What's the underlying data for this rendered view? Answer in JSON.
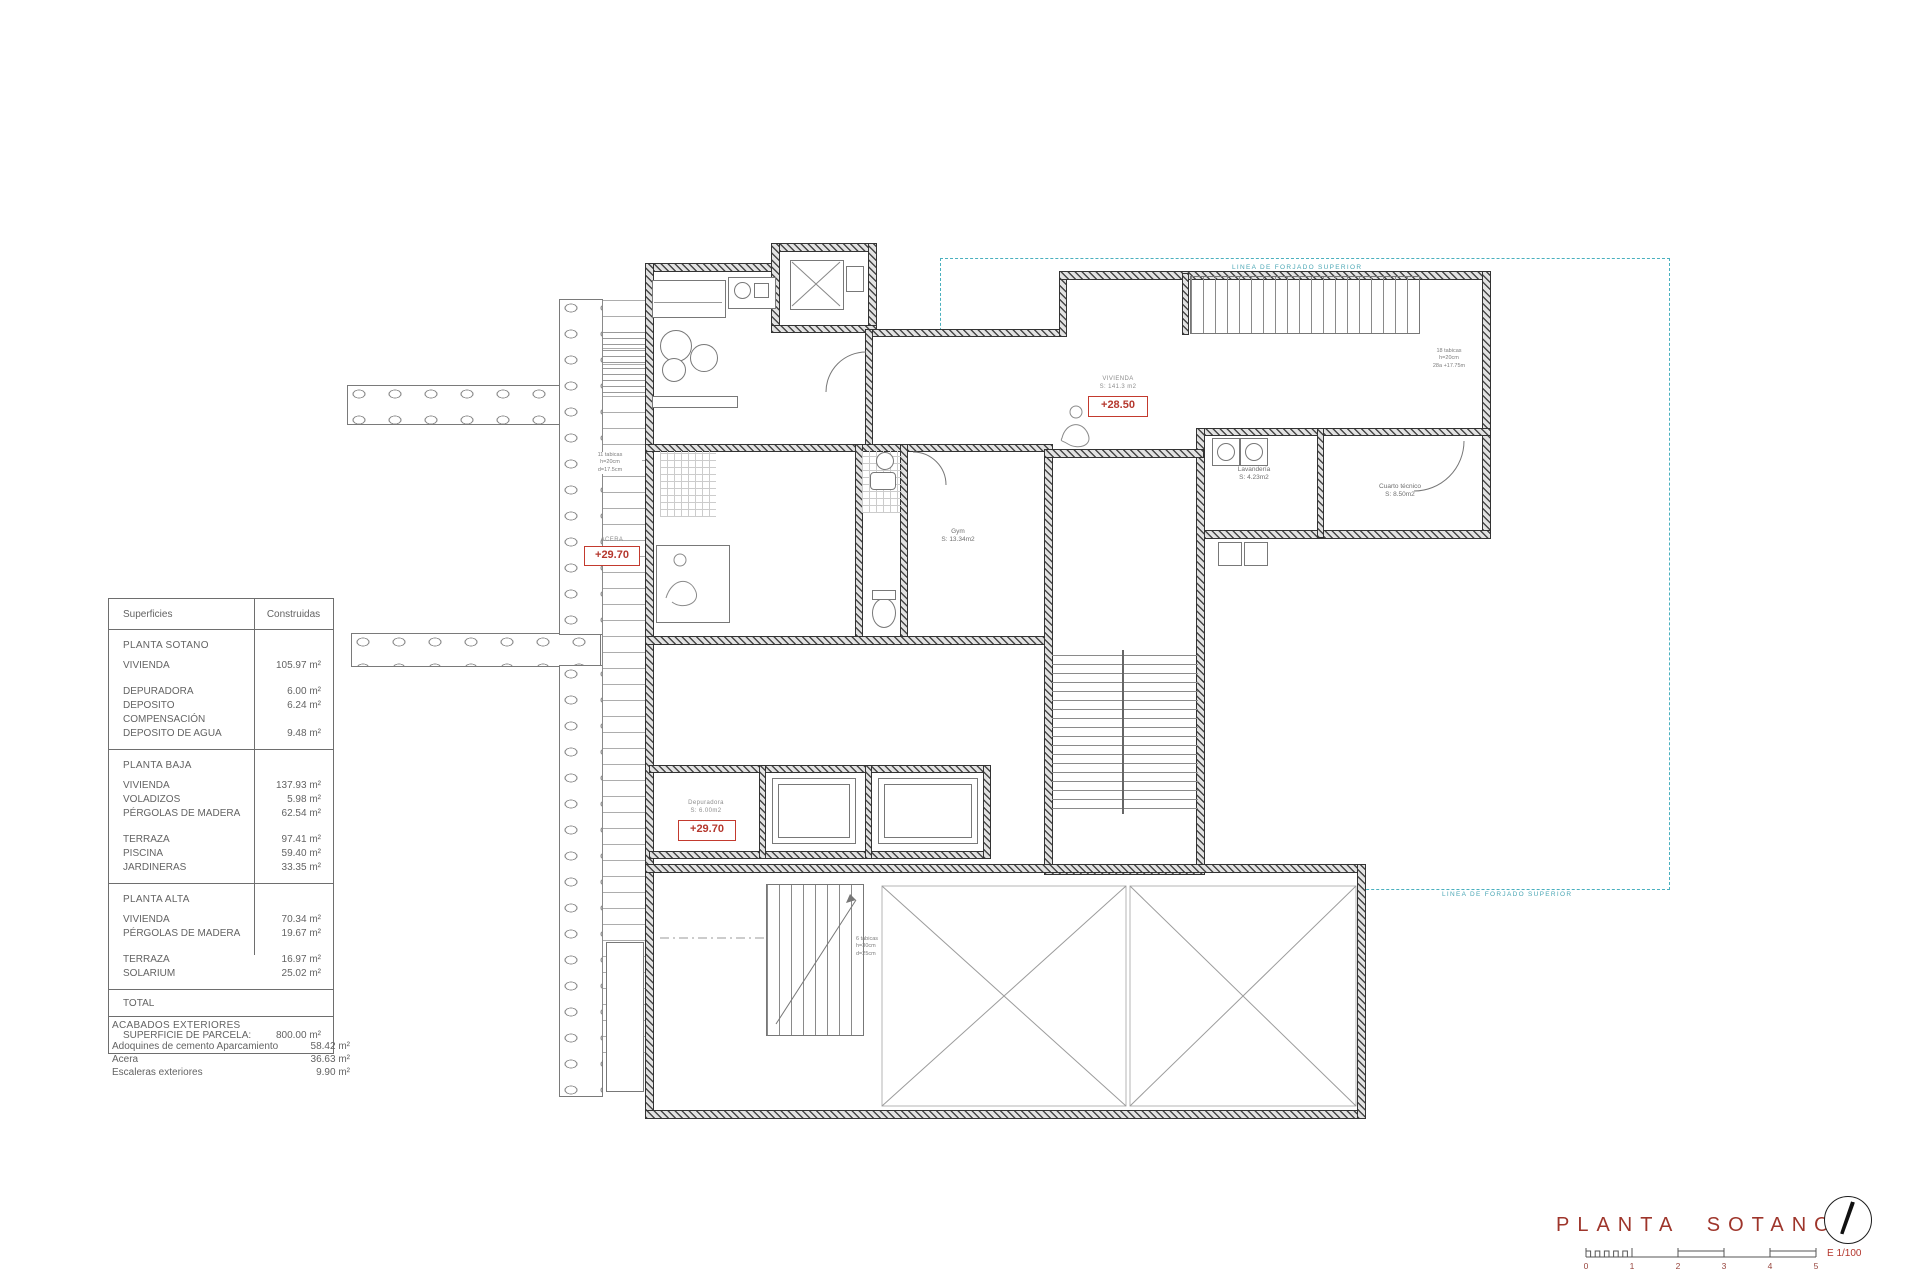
{
  "surfaces_table": {
    "header": {
      "superficies": "Superficies",
      "construidas": "Construidas"
    },
    "planta_sotano": {
      "title": "PLANTA SOTANO",
      "rows": [
        {
          "label": "VIVIENDA",
          "value": "105.97 m²"
        },
        {
          "label": "DEPURADORA",
          "value": "6.00 m²"
        },
        {
          "label": "DEPOSITO COMPENSACIÓN",
          "value": "6.24 m²"
        },
        {
          "label": "DEPOSITO DE AGUA",
          "value": "9.48 m²"
        }
      ]
    },
    "planta_baja": {
      "title": "PLANTA BAJA",
      "rows": [
        {
          "label": "VIVIENDA",
          "value": "137.93 m²"
        },
        {
          "label": "VOLADIZOS",
          "value": "5.98 m²"
        },
        {
          "label": "PÉRGOLAS DE MADERA",
          "value": "62.54 m²"
        },
        {
          "label": "TERRAZA",
          "value": "97.41 m²"
        },
        {
          "label": "PISCINA",
          "value": "59.40 m²"
        },
        {
          "label": "JARDINERAS",
          "value": "33.35 m²"
        }
      ]
    },
    "planta_alta": {
      "title": "PLANTA ALTA",
      "rows": [
        {
          "label": "VIVIENDA",
          "value": "70.34 m²"
        },
        {
          "label": "PÉRGOLAS DE MADERA",
          "value": "19.67 m²"
        },
        {
          "label": "TERRAZA",
          "value": "16.97 m²"
        },
        {
          "label": "SOLARIUM",
          "value": "25.02 m²"
        }
      ]
    },
    "total_label": "TOTAL",
    "parcela_label": "SUPERFICIE DE PARCELA:",
    "parcela_value": "800.00 m²"
  },
  "acabados": {
    "title": "ACABADOS EXTERIORES",
    "rows": [
      {
        "label": "Adoquines de cemento Aparcamiento",
        "value": "58.42 m²"
      },
      {
        "label": "Acera",
        "value": "36.63 m²"
      },
      {
        "label": "Escaleras exteriores",
        "value": "9.90 m²"
      }
    ]
  },
  "plan": {
    "forjado_top": "LINEA DE FORJADO SUPERIOR",
    "forjado_bottom": "LINEA DE FORJADO SUPERIOR",
    "levels": {
      "acera": {
        "caption": "ACERA",
        "value": "+29.70"
      },
      "depuradora": {
        "caption1": "Depuradora",
        "caption2": "S: 6.00m2",
        "value": "+29.70"
      },
      "vivienda": {
        "caption1": "VIVIENDA",
        "caption2": "S: 141.3 m2",
        "value": "+28.50"
      }
    },
    "rooms": {
      "gym": {
        "name": "Gym",
        "area": "S: 13.34m2"
      },
      "lavanderia": {
        "name": "Lavandería",
        "area": "S: 4.23m2"
      },
      "cuarto_tecnico": {
        "name": "Cuarto técnico",
        "area": "S: 8.50m2"
      }
    },
    "stair_notes": {
      "interior": {
        "l1": "18 tabicas",
        "l2": "h=20cm",
        "l3": "28a +17.75m"
      },
      "exterior": {
        "l1": "11 tabicas",
        "l2": "h=20cm",
        "l3": "d=17.5cm"
      },
      "garage": {
        "l1": "6 tabicas",
        "l2": "h=30cm",
        "l3": "d=25cm"
      }
    }
  },
  "titleblock": {
    "title": "PLANTA SOTANO",
    "scale": "E 1/100",
    "ticks": [
      "0",
      "1",
      "2",
      "3",
      "4",
      "5"
    ]
  },
  "colors": {
    "title_red": "#9e352b",
    "annotation_red": "#b5382e",
    "forjado_cyan": "#4ab0bf",
    "line_dark": "#3a3a3a"
  }
}
